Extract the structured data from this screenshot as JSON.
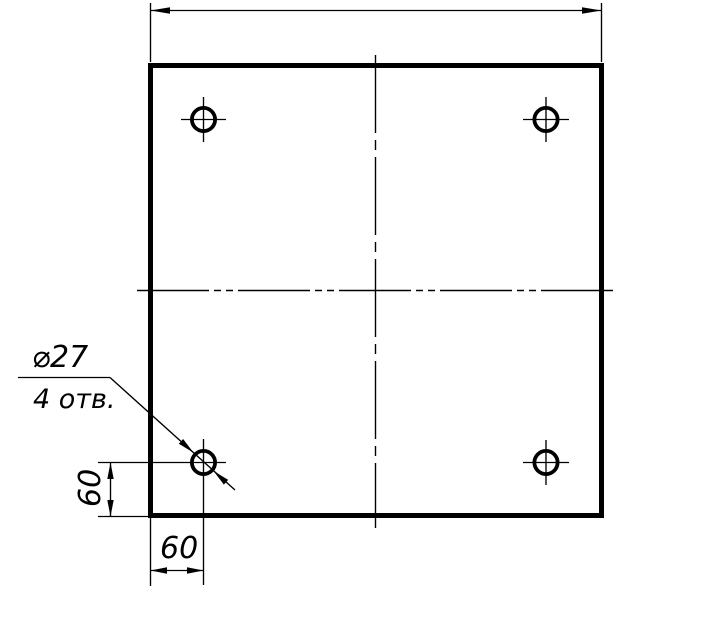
{
  "drawing": {
    "background_color": "#ffffff",
    "line_color": "#000000",
    "hole_callout": {
      "diameter_label": "⌀27",
      "count_label": "4 отв."
    },
    "dimensions": {
      "hole_offset_horizontal": "60",
      "hole_offset_vertical": "60",
      "overall_width_label": ""
    }
  }
}
